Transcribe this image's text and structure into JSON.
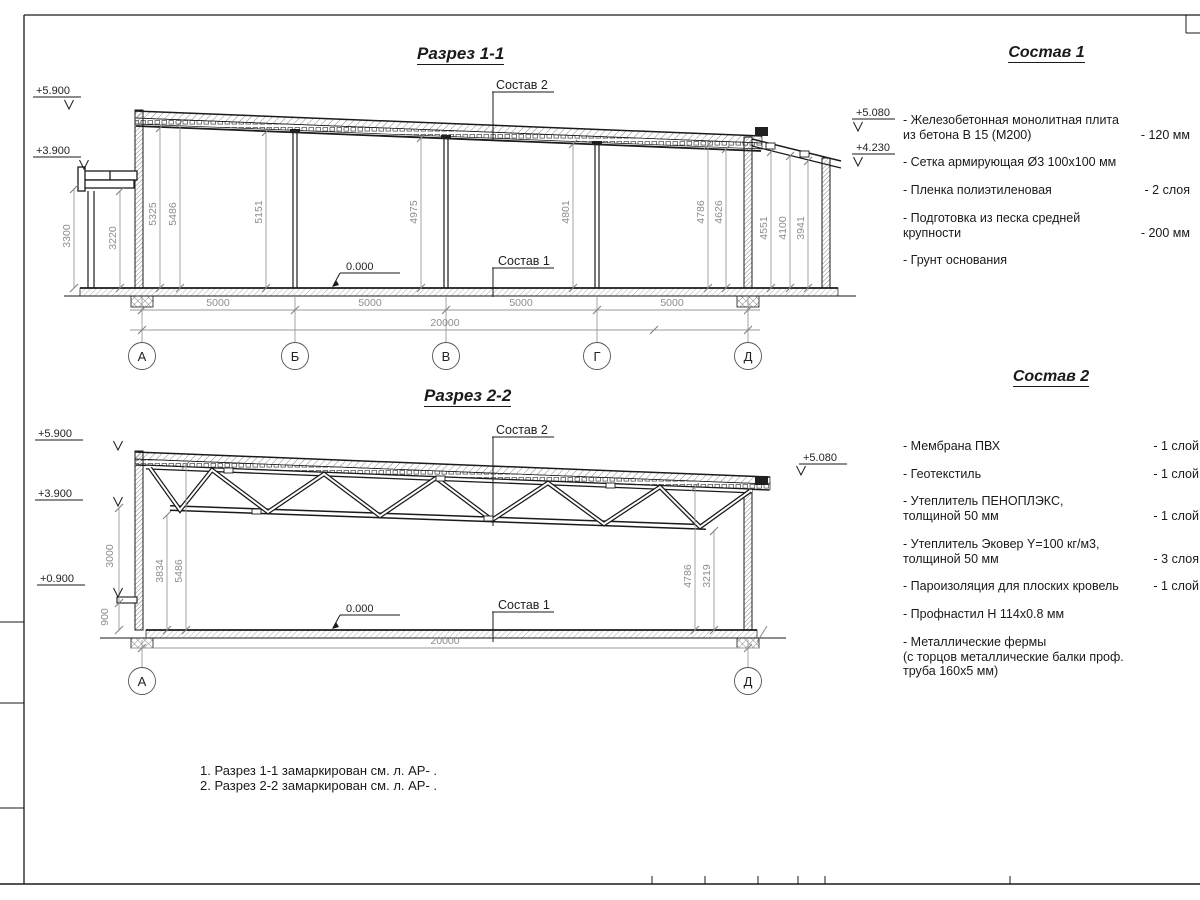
{
  "titles": {
    "s1": "Разрез 1-1",
    "s2": "Разрез 2-2"
  },
  "s1": {
    "elev": {
      "p5900": "+5.900",
      "p3900": "+3.900",
      "p5080": "+5.080",
      "p4230": "+4.230",
      "zero": "0.000"
    },
    "leaders": {
      "c1": "Состав 1",
      "c2": "Состав 2"
    },
    "vdims": {
      "d3300": "3300",
      "d3220": "3220",
      "d5325": "5325",
      "d5486": "5486",
      "d5151": "5151",
      "d4975": "4975",
      "d4801": "4801",
      "d4786": "4786",
      "d4626": "4626",
      "d4551": "4551",
      "d4100": "4100",
      "d3941": "3941"
    },
    "hdims": {
      "b1": "5000",
      "b2": "5000",
      "b3": "5000",
      "b4": "5000",
      "total": "20000"
    },
    "axes": {
      "a": "А",
      "b": "Б",
      "v": "В",
      "g": "Г",
      "d": "Д"
    }
  },
  "s2": {
    "elev": {
      "p5900": "+5.900",
      "p3900": "+3.900",
      "p0900": "+0.900",
      "p5080": "+5.080",
      "zero": "0.000"
    },
    "leaders": {
      "c1": "Состав 1",
      "c2": "Состав 2"
    },
    "vdims": {
      "d3000": "3000",
      "d900": "900",
      "d3834": "3834",
      "d5486": "5486",
      "d4786": "4786",
      "d3219": "3219"
    },
    "hdims": {
      "total": "20000"
    },
    "axes": {
      "a": "А",
      "d": "Д"
    }
  },
  "comp1": {
    "title": "Состав 1",
    "items": [
      {
        "name": "- Железобетонная  монолитная плита\n  из бетона В 15 (М200)",
        "value": "- 120 мм"
      },
      {
        "name": "- Сетка армирующая Ø3 100х100 мм",
        "value": ""
      },
      {
        "name": "- Пленка полиэтиленовая",
        "value": "- 2 слоя"
      },
      {
        "name": "- Подготовка из песка средней\n  крупности",
        "value": "- 200 мм"
      },
      {
        "name": "- Грунт основания",
        "value": ""
      }
    ]
  },
  "comp2": {
    "title": "Состав 2",
    "items": [
      {
        "name": "- Мембрана ПВХ",
        "value": "- 1 слой"
      },
      {
        "name": "- Геотекстиль",
        "value": "- 1 слой"
      },
      {
        "name": "- Утеплитель ПЕНОПЛЭКС,\n  толщиной 50 мм",
        "value": "- 1 слой"
      },
      {
        "name": "- Утеплитель Эковер Y=100 кг/м3,\n  толщиной 50 мм",
        "value": "- 3 слоя"
      },
      {
        "name": "- Пароизоляция для плоских кровель",
        "value": "- 1 слой"
      },
      {
        "name": "- Профнастил Н 114х0.8 мм",
        "value": ""
      },
      {
        "name": "- Металлические фермы\n  (с торцов металлические балки проф.\n  труба 160х5 мм)",
        "value": ""
      }
    ]
  },
  "notes": {
    "n1": "1. Разрез 1-1 замаркирован см. л. АР- .",
    "n2": "2. Разрез 2-2 замаркирован см. л. АР- ."
  }
}
